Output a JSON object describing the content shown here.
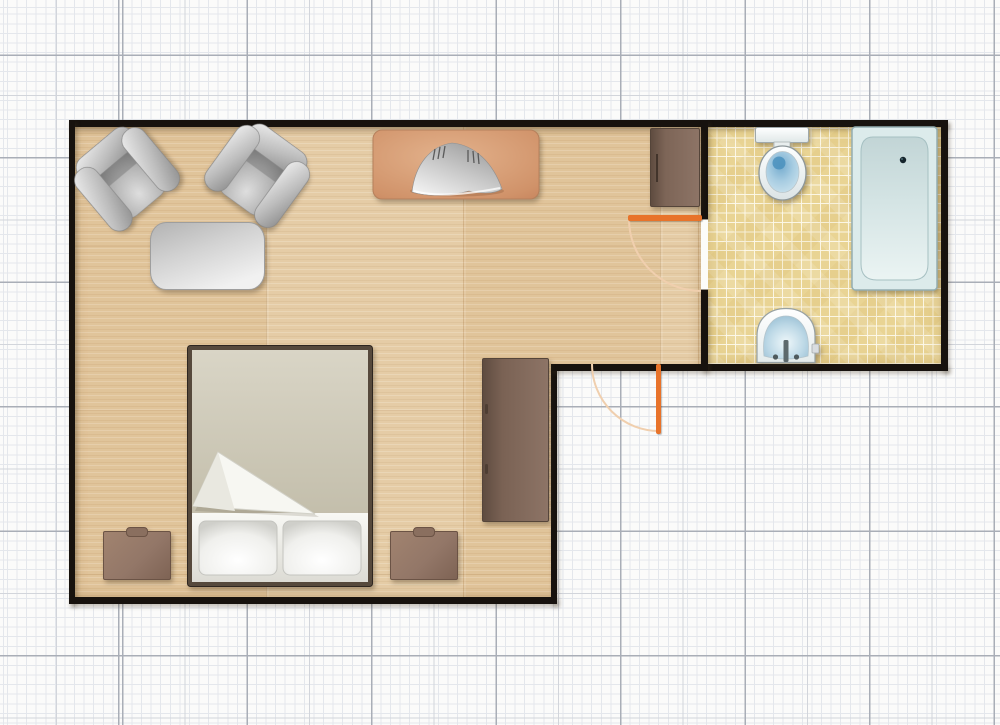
{
  "app": {
    "name": "Floor plan canvas",
    "canvas_width": 1000,
    "canvas_height": 725
  },
  "grid": {
    "background": "#fbfbfa",
    "fine_spacing_px": 9.6,
    "medium_spacing_px": 62.25,
    "major_spacing_px": 124.5,
    "fine_color": "#e4e7ec",
    "medium_color": "#d2d5db",
    "major_color": "#a9aeb7"
  },
  "walls": {
    "color": "#17120e",
    "thickness_px": 6,
    "label": "Wall"
  },
  "rooms": [
    {
      "id": "main-room",
      "label": "Living / bedroom",
      "shape": "L-shaped",
      "floor": "light wood planks",
      "floor_color": "#e2c79e"
    },
    {
      "id": "bathroom",
      "label": "Bathroom",
      "shape": "rectangular",
      "floor": "yellow mosaic tile",
      "floor_color": "#e9d494",
      "grout_color": "#faf5e3"
    }
  ],
  "doors": [
    {
      "id": "bathroom-door",
      "label": "Bathroom door",
      "leaf_color": "#e8732a",
      "arc_color": "#f0cfae",
      "state": "open 90 deg into main room"
    },
    {
      "id": "entry-door",
      "label": "Entry door",
      "leaf_color": "#e8732a",
      "arc_color": "#f0cfae",
      "state": "open 90 deg outward"
    }
  ],
  "furniture": [
    {
      "id": "armchair-1",
      "label": "Armchair",
      "color": "gray",
      "rotation_deg": -40
    },
    {
      "id": "armchair-2",
      "label": "Armchair",
      "color": "gray",
      "rotation_deg": 36
    },
    {
      "id": "coffee-table",
      "label": "Coffee table",
      "color": "gray"
    },
    {
      "id": "fireplace",
      "label": "Fireplace",
      "body_color": "#d59c74",
      "hood_color": "silver"
    },
    {
      "id": "hall-cabinet",
      "label": "Cabinet",
      "color": "brown"
    },
    {
      "id": "wardrobe",
      "label": "Wardrobe",
      "color": "brown"
    },
    {
      "id": "double-bed",
      "label": "Double bed",
      "pillows": 2,
      "blanket_color": "#cdc8b5",
      "sheet_color": "#f1f0ea"
    },
    {
      "id": "nightstand-left",
      "label": "Nightstand",
      "color": "brown"
    },
    {
      "id": "nightstand-right",
      "label": "Nightstand",
      "color": "brown"
    }
  ],
  "bathroom_fixtures": [
    {
      "id": "toilet",
      "label": "Toilet",
      "water_color": "#4a90bd"
    },
    {
      "id": "bathtub",
      "label": "Bathtub",
      "color": "#d9e8e8",
      "drain": "top-right"
    },
    {
      "id": "sink",
      "label": "Washbasin",
      "basin_color": "#a9c9da"
    }
  ]
}
